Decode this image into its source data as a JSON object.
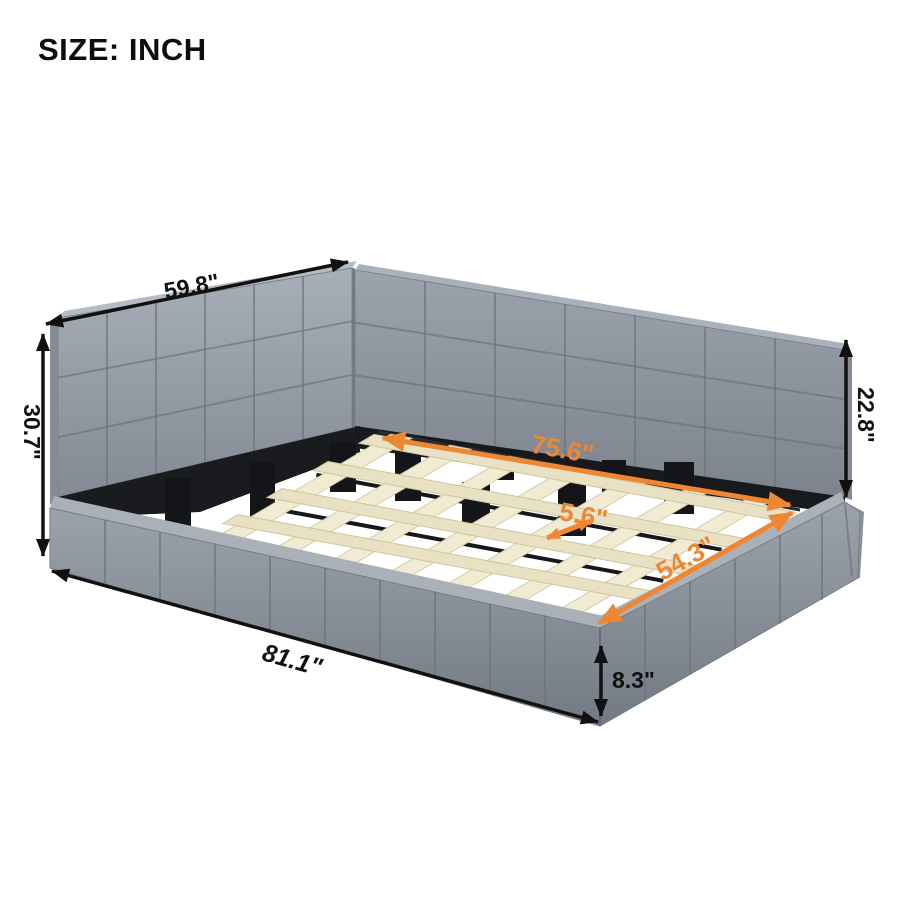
{
  "title": "SIZE: INCH",
  "unit": "inch",
  "scene": {
    "description": "Gray upholstered L-shaped platform daybed with corner headboard and long side backrest, wooden slat lattice support on black metal legs, annotated with product dimensions."
  },
  "dimensions": {
    "headboard_width": {
      "label": "59.8\"",
      "value": 59.8
    },
    "headboard_height": {
      "label": "30.7\"",
      "value": 30.7
    },
    "backrest_height": {
      "label": "22.8\"",
      "value": 22.8
    },
    "slat_area_length": {
      "label": "75.6\"",
      "value": 75.6
    },
    "slat_spacing": {
      "label": "5.6\"",
      "value": 5.6
    },
    "slat_area_width": {
      "label": "54.3\"",
      "value": 54.3
    },
    "overall_length": {
      "label": "81.1\"",
      "value": 81.1
    },
    "side_rail_height": {
      "label": "8.3\"",
      "value": 8.3
    }
  },
  "colors": {
    "accent_orange": "#ED8733",
    "dimension_black": "#111111",
    "fabric_gray": "#98A0A9",
    "slat_wood": "#F0E8CF",
    "leg_black": "#141518",
    "background": "#FFFFFF"
  }
}
